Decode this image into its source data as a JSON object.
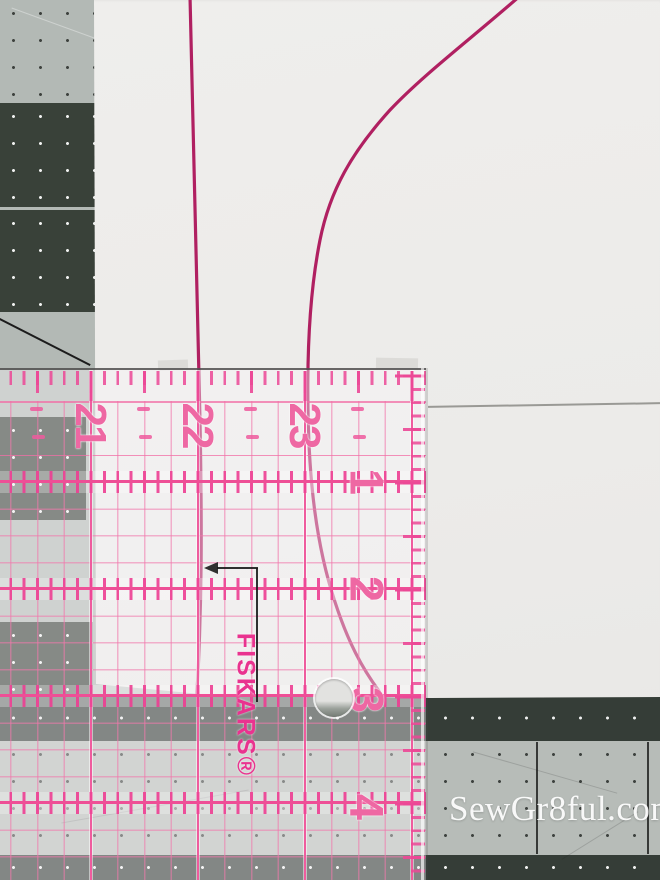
{
  "watermark": {
    "text": "SewGr8ful.com"
  },
  "ruler": {
    "brand_label": "FISKARS®",
    "top_numbers": [
      "21",
      "22",
      "23"
    ],
    "side_numbers": [
      "1",
      "2",
      "3",
      "4"
    ],
    "colors": {
      "grid_pink": "#f178ac",
      "tick_pink": "#ee4f96",
      "number_pink": "#ee68a3",
      "brand_magenta": "#e9338f"
    }
  },
  "pattern_paper": {
    "curve_color": "#b02061"
  },
  "mat": {
    "light_color": "#b3b9b5",
    "dark_color": "#394139"
  }
}
